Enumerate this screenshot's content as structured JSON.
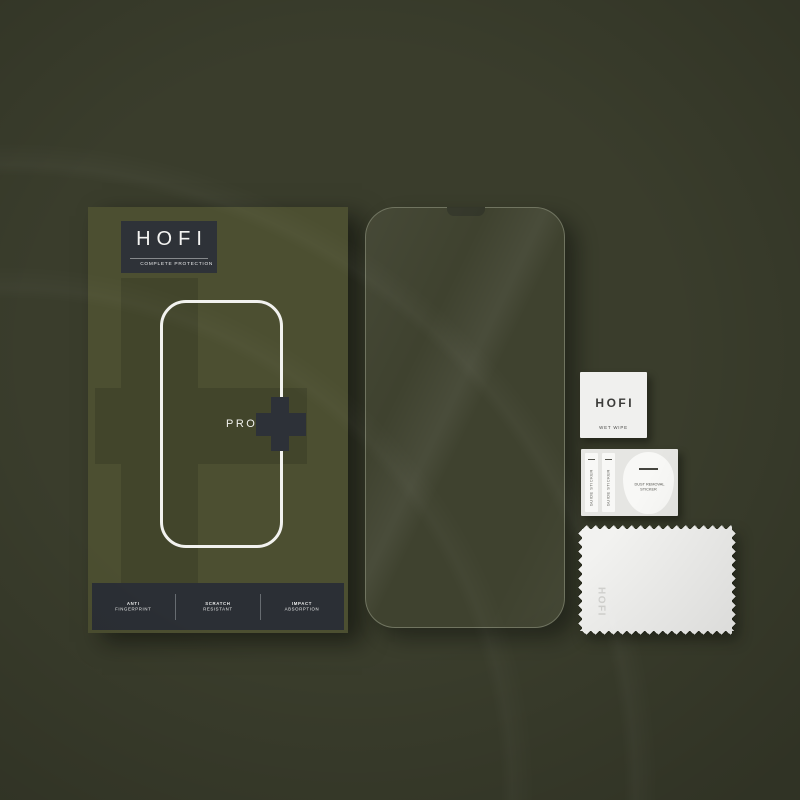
{
  "scene": {
    "description": "HOFI Glass Pro+ tempered glass screen protector kit flat lay product photo",
    "colors": {
      "background": "#3a3d2c",
      "box_olive": "#4c4f31",
      "dark_panel": "#2e3238",
      "white": "#f2f2f0",
      "glass_tint": "#3f422f"
    }
  },
  "box": {
    "brand": "HOFI",
    "tagline": "COMPLETE PROTECTION",
    "pro_label": "PRO",
    "features": [
      {
        "line1": "ANTI",
        "line2": "FINGERPRINT"
      },
      {
        "line1": "SCRATCH",
        "line2": "RESISTANT"
      },
      {
        "line1": "IMPACT",
        "line2": "ABSORPTION"
      }
    ]
  },
  "accessories": {
    "wet_wipe": {
      "brand": "HOFI",
      "label": "WET WIPE"
    },
    "guide_sticker_1": {
      "label": "GUIDE STICKER"
    },
    "guide_sticker_2": {
      "label": "GUIDE STICKER"
    },
    "dust_removal_sticker": {
      "line1": "DUST REMOVAL",
      "line2": "STICKER"
    },
    "cloth": {
      "brand": "HOFI"
    }
  }
}
